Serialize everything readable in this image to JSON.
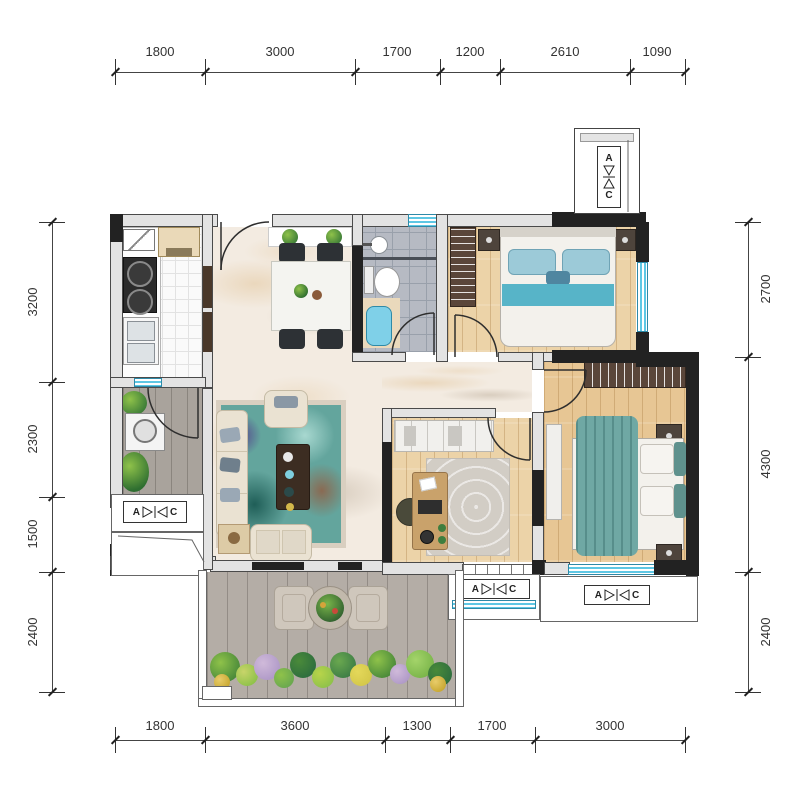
{
  "dims": {
    "top": [
      "1800",
      "3000",
      "1700",
      "1200",
      "2610",
      "1090"
    ],
    "bottom": [
      "1800",
      "3600",
      "1300",
      "1700",
      "3000"
    ],
    "left": [
      "3200",
      "2300",
      "1500",
      "2400"
    ],
    "right": [
      "2700",
      "4300",
      "2400"
    ]
  },
  "ac_unit": {
    "left": "A",
    "right": "C"
  },
  "palette": {
    "wall_dark": "#222222",
    "wall_light": "#e3e3e3",
    "window_blue": "#5ec7e4",
    "wood_floor": "#e7c694",
    "marble_floor": "#f3ebe1",
    "rug_teal": "#7ab5ae",
    "balcony_gray": "#b4ada6"
  }
}
